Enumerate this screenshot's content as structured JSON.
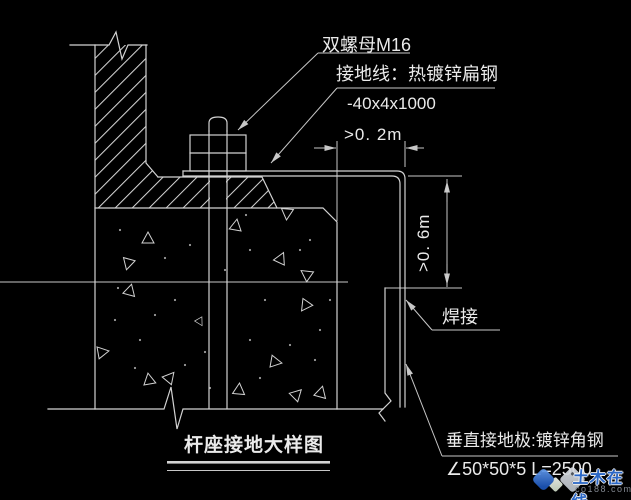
{
  "drawing": {
    "title": "杆座接地大样图",
    "labels": {
      "nut": "双螺母M16",
      "ground_wire": "接地线：热镀锌扁钢",
      "ground_wire_spec": "-40x4x1000",
      "weld": "焊接",
      "vertical_electrode": "垂直接地极:镀锌角钢",
      "vertical_electrode_spec": "∠50*50*5 L=2500"
    },
    "dimensions": {
      "horizontal_clearance": ">0. 2m",
      "burial_depth": ">0. 6m"
    },
    "colors": {
      "background": "#000000",
      "line": "#d2d2d2",
      "text": "#eaeaea"
    }
  },
  "watermark": {
    "brand": "土木在线",
    "domain": "co188.com",
    "colors": {
      "blue": "#2e6fd6",
      "gray_diamond": "#b9bfc7",
      "url_gray": "#8e949e"
    }
  }
}
